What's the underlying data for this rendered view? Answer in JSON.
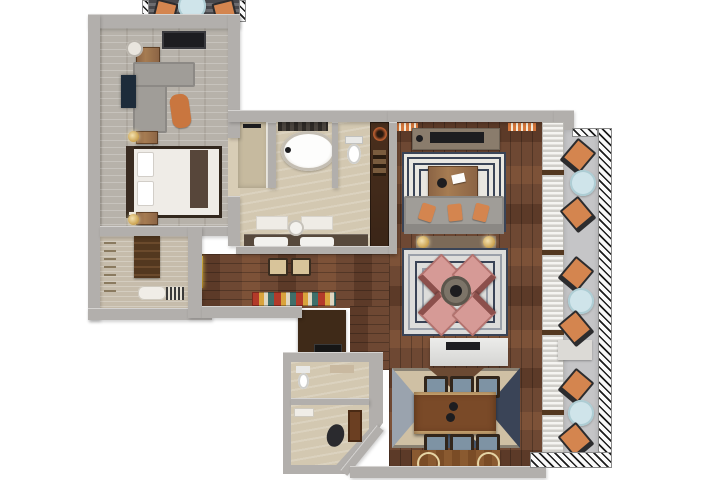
{
  "scene": {
    "type": "3d-floor-plan-render",
    "view": "top-down",
    "description": "Luxury suite floor plan: bedroom, walk-in closet, master bathroom, hallway, living room, lounge, dining area, powder room, foyer, and two balconies",
    "background": "#ffffff"
  },
  "palette": {
    "bg": "#ffffff",
    "wall": "#b2afac",
    "bedroomFloor": "#b7b2aa",
    "carpet": "#c6bcab",
    "wood": "#6e4833",
    "woodDark": "#5c3a28",
    "tile": "#d3c8b1",
    "tileDark": "#c6ba9f",
    "balcony": "#c5c5c7",
    "railingInk": "#1c1c1c",
    "orange": "#d4854f",
    "paleBlue": "#cfe4ea",
    "navy": "#3a4457",
    "cream": "#e9e7e1",
    "rose": "#d69a96",
    "roseDark": "#b3736f",
    "sofaGray": "#a09d98",
    "consoleGray": "#8a7c6c",
    "gold": "#caa14e",
    "cabinet": "#3f2a18",
    "counterDark": "#57493c",
    "seatBlue": "#7e93a4",
    "rugTan": "#cfc0a4",
    "islandWhite": "#dedede"
  },
  "rooms": [
    {
      "id": "balcony-top",
      "name": "Upper balcony",
      "floor": "dark wood decking",
      "furniture": "2 orange chairs, 1 round table"
    },
    {
      "id": "bedroom",
      "name": "Master bedroom",
      "floor": "light gray wood planks",
      "furniture": "four-poster bed, 2 nightstands with lamps, L-shaped gray sofa, orange ottoman, desk with stool, wall TV panel, wall art"
    },
    {
      "id": "closet",
      "name": "Walk-in closet",
      "floor": "beige carpet",
      "furniture": "wardrobe, shelving, bench with white pillows, striped mat"
    },
    {
      "id": "bathroom",
      "name": "Master bathroom",
      "floor": "beige tile",
      "furniture": "walk-in shower, freestanding oval tub, toilet room, double-sink vanity, 2 bath mats, round stool"
    },
    {
      "id": "hallway",
      "name": "Hallway",
      "floor": "dark walnut planks",
      "furniture": "2 bar stools, striped runner rug, lit wall art niche, minibar cabinet with copper bowl"
    },
    {
      "id": "living-room",
      "name": "Living room",
      "floor": "dark walnut planks",
      "furniture": "media console with TV, greek-key rug, wood coffee table, gray sofa with 3 orange pillows, console with 2 lamps"
    },
    {
      "id": "lounge",
      "name": "Lounge seating",
      "floor": "dark walnut planks",
      "furniture": "concentric-square rug, 4 rose chairs around round table, white sideboard with tray"
    },
    {
      "id": "dining",
      "name": "Dining area",
      "floor": "dark walnut planks",
      "furniture": "geometric kilim rug, live-edge dining table, 6 blue-seat chairs, bar console with 2 ring wheels"
    },
    {
      "id": "powder-room",
      "name": "Powder room",
      "floor": "beige tile",
      "furniture": "toilet, shelf, dark cabinet block with black counter"
    },
    {
      "id": "foyer",
      "name": "Entry foyer",
      "floor": "beige tile",
      "furniture": "dark vase, door panel, white bench, angled entry wall"
    },
    {
      "id": "balcony-right",
      "name": "Side balcony",
      "floor": "gray concrete",
      "furniture": "6 orange chairs, 3 round pale-blue tables, louvered shutter wall, hatched railing"
    }
  ],
  "counts": {
    "balcony_right_chairs": 6,
    "balcony_right_tables": 3,
    "dining_chairs": 6,
    "rose_chairs": 4,
    "sofa_pillows": 3,
    "vanity_sinks": 2
  }
}
